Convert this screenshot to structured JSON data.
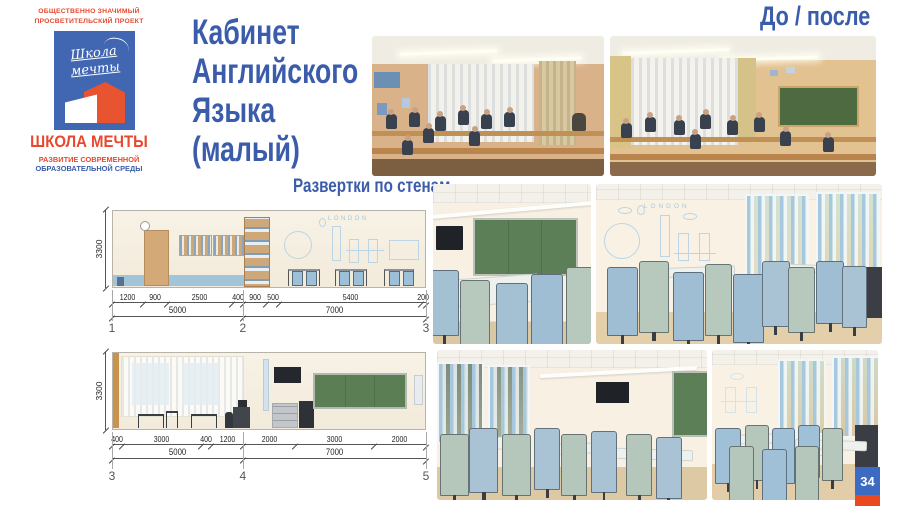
{
  "palette": {
    "accent_blue": "#3b5caa",
    "accent_red": "#e8482e",
    "logo_banner_blue": "#4166b2",
    "chalkboard_green": "#5d7f57",
    "badge_blue": "#3c6bc4",
    "badge_red": "#e8491f"
  },
  "logo": {
    "project_line1": "ОБЩЕСТВЕННО ЗНАЧИМЫЙ",
    "project_line2": "ПРОСВЕТИТЕЛЬСКИЙ ПРОЕКТ",
    "banner_script_line1": "Школа",
    "banner_script_line2": "мечты",
    "name": "ШКОЛА МЕЧТЫ",
    "tagline_line1": "РАЗВИТИЕ СОВРЕМЕННОЙ",
    "tagline_line2": "ОБРАЗОВАТЕЛЬНОЙ СРЕДЫ"
  },
  "title": {
    "line1": "Кабинет",
    "line2": "Английского",
    "line3": "Языка",
    "line4": "(малый)"
  },
  "labels": {
    "before_after": "До / после",
    "elevations": "Развертки по стенам"
  },
  "drawing1": {
    "height_dim": "3300",
    "segments": [
      "1200",
      "900",
      "2500",
      "400",
      "900",
      "500",
      "5400",
      "200"
    ],
    "totals": [
      "5000",
      "7000"
    ],
    "markers": [
      "1",
      "2",
      "3"
    ],
    "mural_text": "LONDON"
  },
  "drawing2": {
    "height_dim": "3300",
    "segments": [
      "400",
      "3000",
      "400",
      "1200",
      "2000",
      "3000",
      "2000"
    ],
    "totals": [
      "5000",
      "7000"
    ],
    "markers": [
      "3",
      "4",
      "5"
    ]
  },
  "renders": {
    "mural_text": "LONDON"
  },
  "page_number": "34"
}
